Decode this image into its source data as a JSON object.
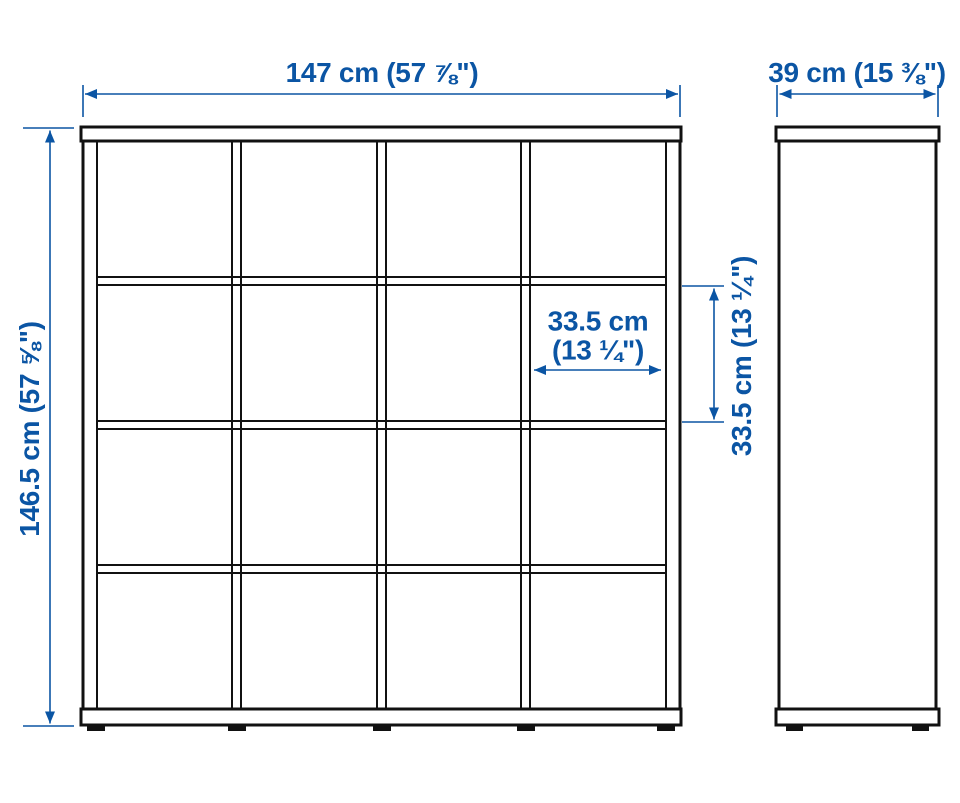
{
  "diagram": {
    "type": "product-dimension-diagram",
    "description": "Cube storage shelving unit, front view with 4x4 grid of square compartments and narrow side view",
    "views": {
      "front": {
        "columns": 4,
        "rows": 4,
        "feet_count": 5
      },
      "side": {
        "feet_count": 2
      }
    }
  },
  "labels": {
    "overall_width": "147 cm (57 ⅞\")",
    "depth": "39 cm (15 ⅜\")",
    "overall_height": "146.5 cm (57 ⅝\")",
    "cell_width_line1": "33.5 cm",
    "cell_width_line2": "(13 ¼\")",
    "cell_height": "33.5 cm (13 ¼\")"
  },
  "colors": {
    "background": "#ffffff",
    "line_color": "#111111",
    "dim_color": "#0b55a4"
  }
}
